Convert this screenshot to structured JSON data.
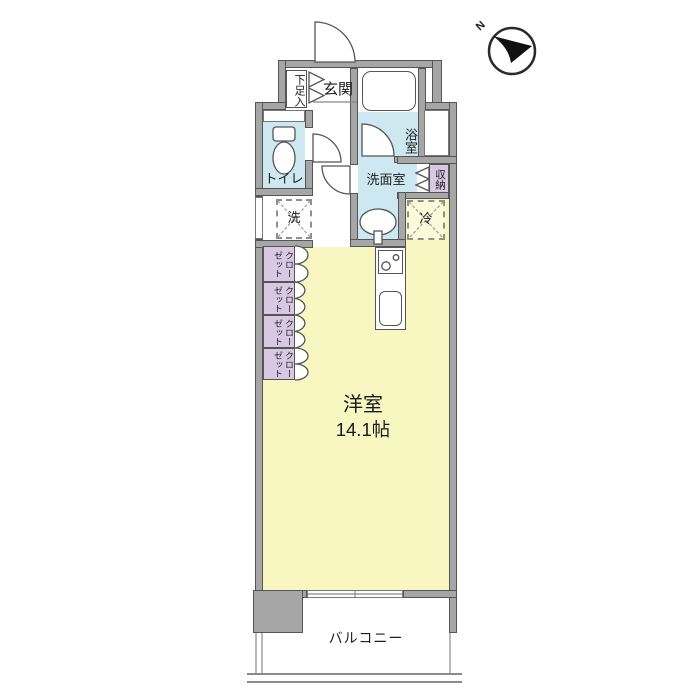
{
  "compass": {
    "north_label": "N"
  },
  "rooms": {
    "entrance": "玄関",
    "shoe_cabinet": "下足入",
    "bathroom": "浴室",
    "washroom": "洗面室",
    "storage": "収納",
    "toilet": "トイレ",
    "washer": "洗",
    "fridge": "冷",
    "closet": "クローゼット",
    "main_room_name": "洋室",
    "main_room_size": "14.1帖",
    "balcony": "バルコニー"
  },
  "colors": {
    "wall_fill": "#a6a6a6",
    "wall_edge": "#555555",
    "wet_area_fill": "#cde8f0",
    "main_room_fill": "#f8f6c1",
    "closet_fill": "#d9c8e4",
    "background": "#ffffff"
  }
}
